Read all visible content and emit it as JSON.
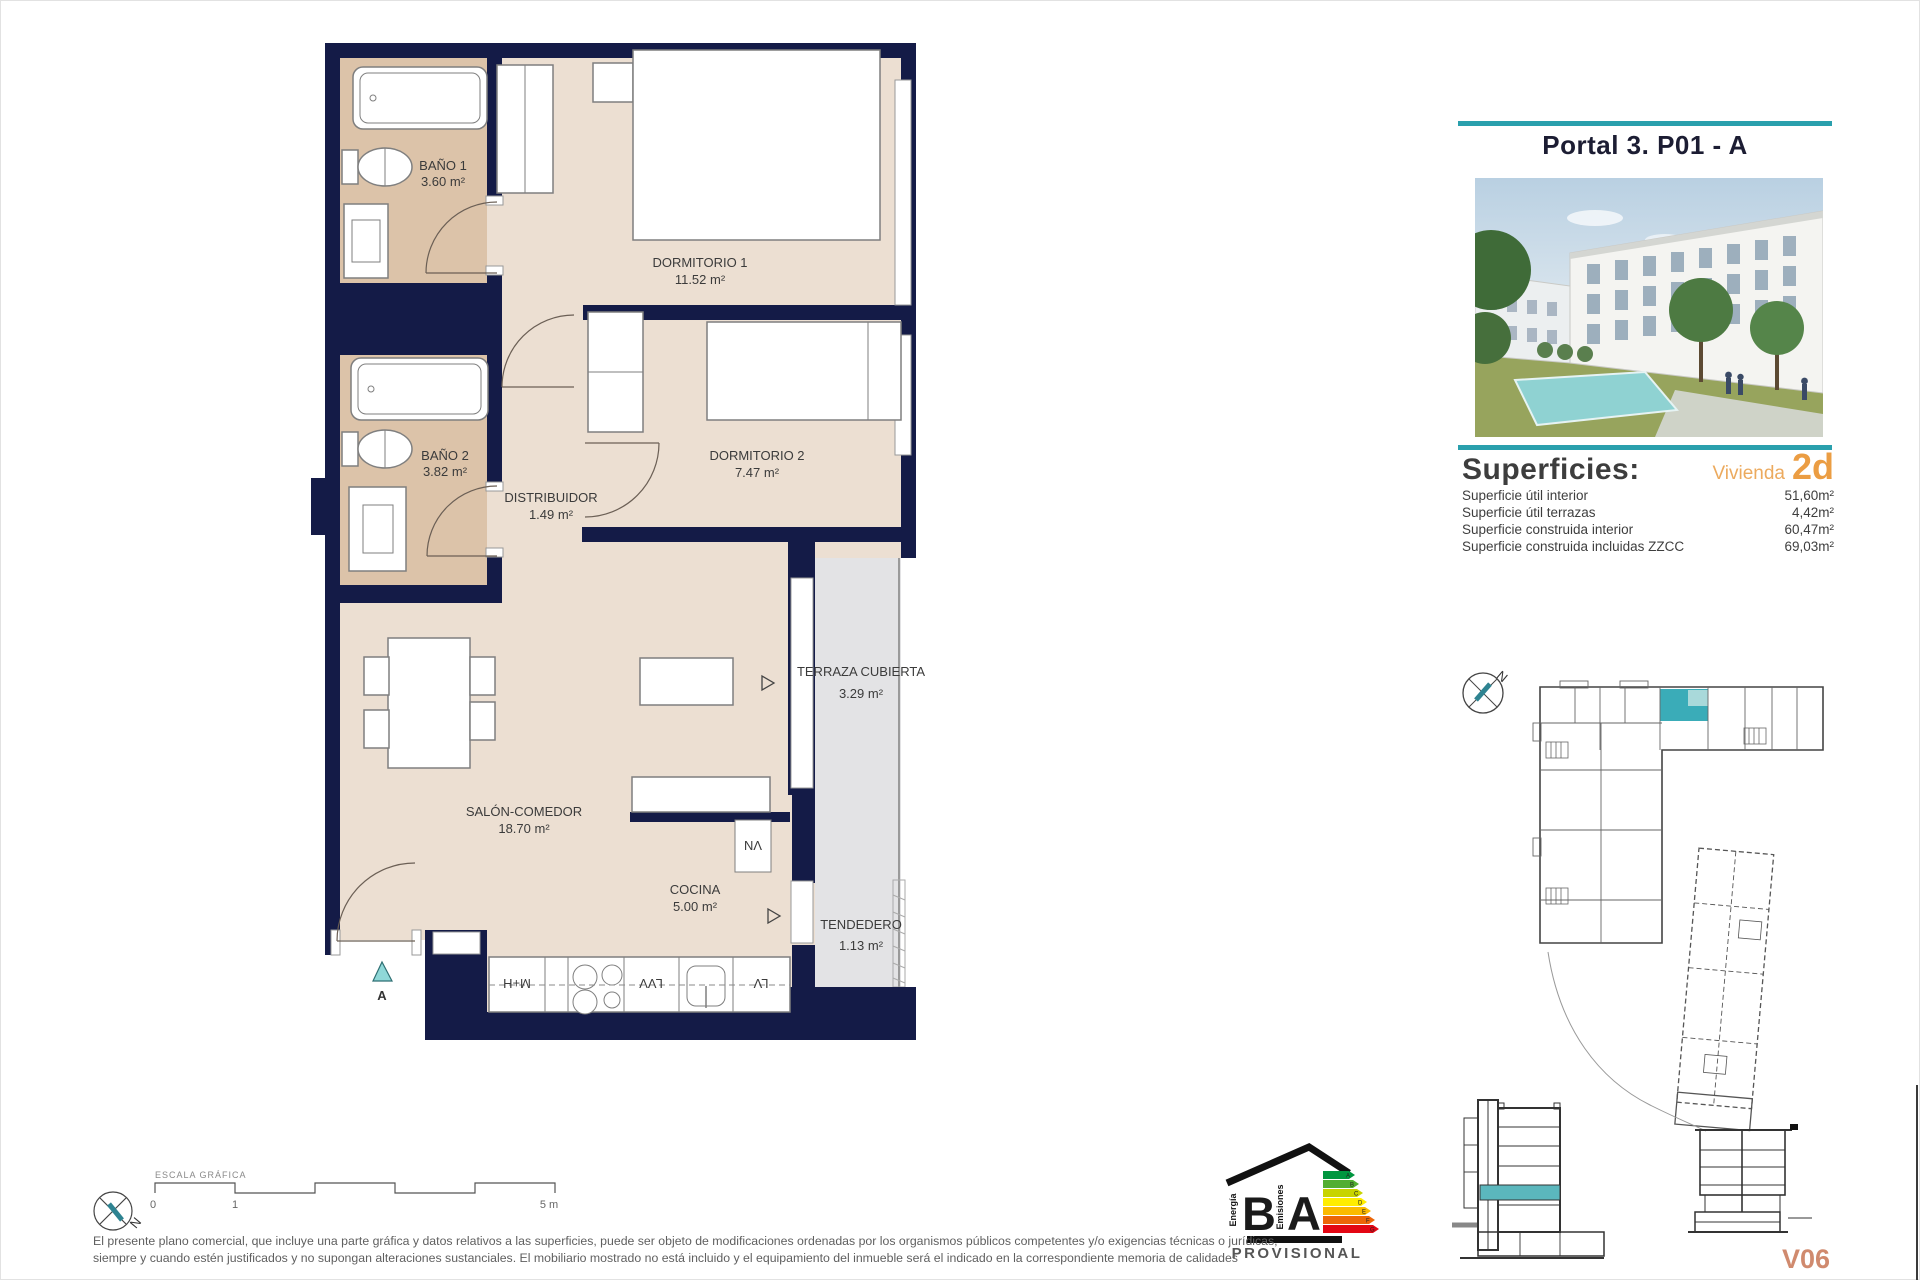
{
  "header": {
    "title": "Portal 3. P01 - A"
  },
  "plan": {
    "rooms": [
      {
        "name": "BAÑO 1",
        "area": "3.60 m²"
      },
      {
        "name": "BAÑO 2",
        "area": "3.82 m²"
      },
      {
        "name": "DORMITORIO 1",
        "area": "11.52 m²"
      },
      {
        "name": "DORMITORIO 2",
        "area": "7.47 m²"
      },
      {
        "name": "DISTRIBUIDOR",
        "area": "1.49 m²"
      },
      {
        "name": "SALÓN-COMEDOR",
        "area": "18.70 m²"
      },
      {
        "name": "COCINA",
        "area": "5.00 m²"
      },
      {
        "name": "TERRAZA CUBIERTA",
        "area": "3.29 m²"
      },
      {
        "name": "TENDEDERO",
        "area": "1.13 m²"
      }
    ],
    "entrance_label": "A",
    "kitchen_units": [
      "M+H",
      "LVV",
      "LV"
    ],
    "shaft_label": "VN"
  },
  "superficies": {
    "title": "Superficies:",
    "vivienda_label": "Vivienda",
    "vivienda_type": "2d",
    "rows": [
      {
        "label": "Superficie útil interior",
        "value": "51,60m²"
      },
      {
        "label": "Superficie útil terrazas",
        "value": "4,42m²"
      },
      {
        "label": "Superficie construida interior",
        "value": "60,47m²"
      },
      {
        "label": "Superficie construida incluidas ZZCC",
        "value": "69,03m²"
      }
    ]
  },
  "site": {
    "north_label": "N"
  },
  "sections": {
    "version_label": "V06"
  },
  "energy": {
    "letter_b": "B",
    "letter_a": "A",
    "left_text": "Energía",
    "right_text": "Emisiones",
    "provisional": "PROVISIONAL",
    "scale": [
      "A",
      "B",
      "C",
      "D",
      "E",
      "F",
      "G"
    ]
  },
  "scalebar": {
    "title": "ESCALA GRÁFICA",
    "tick0": "0",
    "tick1": "1",
    "tick5": "5 m"
  },
  "compass": {
    "north_label": "N"
  },
  "disclaimer": {
    "line1": "El presente plano comercial, que incluye una parte gráfica y datos relativos a las superficies, puede ser objeto de modificaciones ordenadas por los organismos públicos competentes y/o exigencias técnicas o jurídicas,",
    "line2": "siempre y cuando estén justificados y no supongan alteraciones sustanciales. El mobiliario mostrado no está incluido y el equipamiento del inmueble será el indicado en la correspondiente memoria de calidades"
  }
}
